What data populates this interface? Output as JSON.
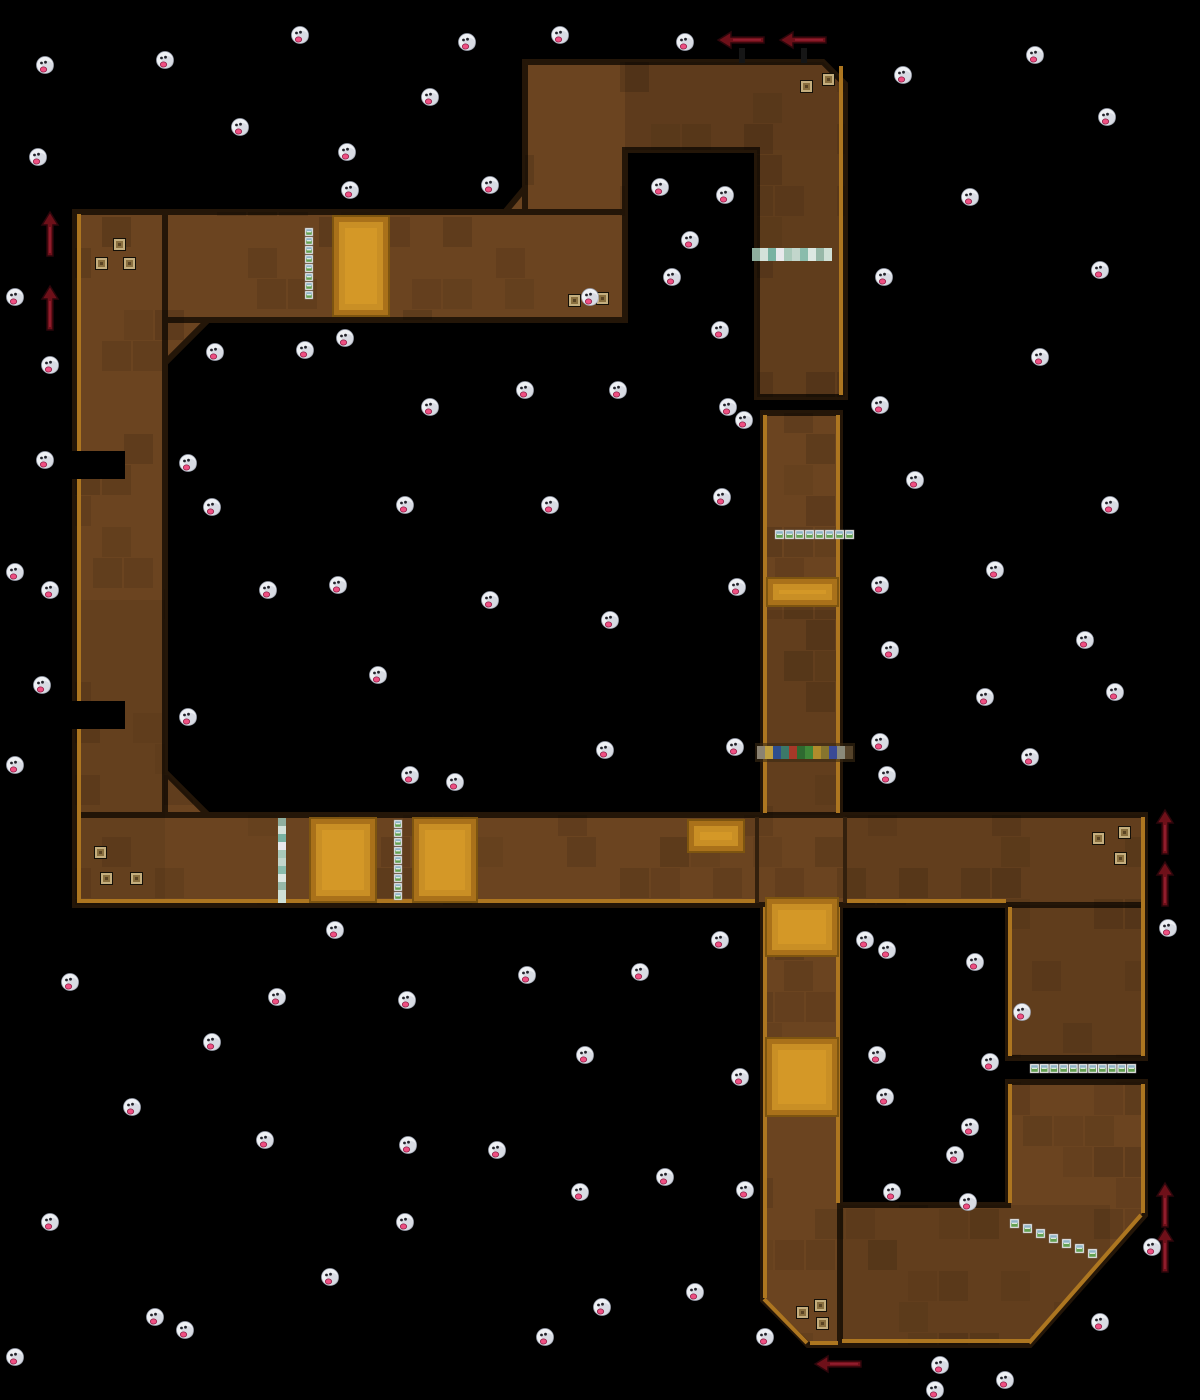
{
  "scene": {
    "width": 1200,
    "height": 1400,
    "background": "#000000"
  },
  "colors": {
    "track_fill": "#6b4420",
    "track_stroke": "#241608",
    "rim": "#ad7620",
    "seam": "#33200d",
    "pad_outer": "#a9711a",
    "pad_edge": "#7e5510",
    "pad_inner": "#c98f25",
    "pad_core": "#d69a28",
    "arrow_fill": "#6e1019",
    "arrow_edge": "#2c060b",
    "arrow_hl": "#a02438",
    "arrow_post": "#161616",
    "boo_body": "#eef0f4",
    "boo_shade": "#c6cad6",
    "boo_edge": "#9aa0ae",
    "boo_eye": "#23232b",
    "boo_tongue": "#ef4f82",
    "boo_tongue_edge": "#8e1f46",
    "box_border": "#f2f2f2",
    "box_top": "#8fb3c6",
    "box_bottom": "#63a052",
    "box_glint": "#ffffff",
    "block_outline": "#141008",
    "block_fill": "#c4ae7e",
    "block_mid": "#8a7040",
    "block_core": "#5a4424"
  },
  "track": {
    "pieces": [
      {
        "type": "poly",
        "name": "top-loop",
        "points": [
          [
            525,
            62
          ],
          [
            823,
            62
          ],
          [
            845,
            84
          ],
          [
            845,
            397
          ],
          [
            757,
            397
          ],
          [
            757,
            150
          ],
          [
            625,
            150
          ],
          [
            625,
            212
          ],
          [
            525,
            212
          ]
        ]
      },
      {
        "type": "rect",
        "name": "top-band",
        "x": 75,
        "y": 212,
        "w": 550,
        "h": 108
      },
      {
        "type": "rect",
        "name": "left-band",
        "x": 75,
        "y": 212,
        "w": 90,
        "h": 693
      },
      {
        "type": "rect",
        "name": "bottom-band",
        "x": 75,
        "y": 815,
        "w": 1070,
        "h": 90
      },
      {
        "type": "rect",
        "name": "mid-vertical",
        "x": 763,
        "y": 413,
        "w": 77,
        "h": 402
      },
      {
        "type": "poly",
        "name": "lower-vertical",
        "points": [
          [
            763,
            905
          ],
          [
            840,
            905
          ],
          [
            840,
            1345
          ],
          [
            808,
            1345
          ],
          [
            763,
            1300
          ]
        ]
      },
      {
        "type": "poly",
        "name": "loop-bottom",
        "points": [
          [
            1008,
            1082
          ],
          [
            1145,
            1082
          ],
          [
            1145,
            1215
          ],
          [
            1030,
            1345
          ],
          [
            840,
            1345
          ],
          [
            840,
            1205
          ],
          [
            1008,
            1205
          ]
        ]
      },
      {
        "type": "rect",
        "name": "loop-right-upper",
        "x": 1008,
        "y": 905,
        "w": 137,
        "h": 153
      },
      {
        "type": "poly",
        "name": "chamfer-a",
        "points": [
          [
            505,
            212
          ],
          [
            525,
            188
          ],
          [
            525,
            212
          ]
        ]
      },
      {
        "type": "poly",
        "name": "chamfer-b",
        "points": [
          [
            165,
            320
          ],
          [
            208,
            320
          ],
          [
            165,
            363
          ]
        ]
      },
      {
        "type": "poly",
        "name": "chamfer-c",
        "points": [
          [
            165,
            815
          ],
          [
            208,
            815
          ],
          [
            165,
            772
          ]
        ]
      }
    ],
    "notches": [
      [
        71,
        451,
        54,
        28
      ],
      [
        71,
        701,
        54,
        28
      ]
    ],
    "rims": [
      [
        79,
        214,
        79,
        903
      ],
      [
        841,
        66,
        841,
        395
      ],
      [
        1143,
        817,
        1143,
        1056
      ],
      [
        1143,
        1084,
        1143,
        1213
      ],
      [
        1141,
        1215,
        1029,
        1343
      ],
      [
        1031,
        1341,
        842,
        1341
      ],
      [
        838,
        1343,
        810,
        1343
      ],
      [
        807,
        1343,
        764,
        1299
      ],
      [
        77,
        901,
        755,
        901
      ],
      [
        847,
        901,
        1006,
        901
      ],
      [
        765,
        415,
        765,
        813
      ],
      [
        838,
        415,
        838,
        813
      ],
      [
        765,
        907,
        765,
        1298
      ],
      [
        838,
        907,
        838,
        1203
      ],
      [
        1010,
        907,
        1010,
        1056
      ],
      [
        1010,
        1084,
        1010,
        1203
      ]
    ],
    "seams": [
      [
        757,
        817,
        757,
        903
      ],
      [
        845,
        817,
        845,
        903
      ]
    ],
    "patches": [
      [
        625,
        62,
        218,
        88,
        0.12
      ],
      [
        757,
        150,
        86,
        247,
        0.1
      ],
      [
        845,
        815,
        298,
        88,
        0.08
      ],
      [
        763,
        610,
        77,
        205,
        0.08
      ],
      [
        75,
        600,
        90,
        300,
        0.06
      ],
      [
        840,
        1205,
        270,
        138,
        0.08
      ],
      [
        1008,
        905,
        137,
        151,
        0.1
      ]
    ]
  },
  "boost_pads": [
    [
      333,
      216,
      56,
      100
    ],
    [
      767,
      578,
      71,
      28
    ],
    [
      688,
      820,
      56,
      32
    ],
    [
      310,
      818,
      66,
      84
    ],
    [
      413,
      818,
      64,
      84
    ],
    [
      766,
      898,
      72,
      58
    ],
    [
      766,
      1038,
      72,
      78
    ]
  ],
  "item_box_groups": [
    {
      "x": 305,
      "y": 228,
      "count": 8,
      "dx": 0,
      "dy": 9,
      "size": 8
    },
    {
      "x": 775,
      "y": 530,
      "count": 8,
      "dx": 10,
      "dy": 0,
      "size": 9
    },
    {
      "x": 394,
      "y": 820,
      "count": 9,
      "dx": 0,
      "dy": 9,
      "size": 8
    },
    {
      "x": 1030,
      "y": 1064,
      "count": 11,
      "dx": 9.7,
      "dy": 0,
      "size": 9
    },
    {
      "x": 1010,
      "y": 1219,
      "count": 7,
      "dx": 13,
      "dy": 5,
      "size": 9
    }
  ],
  "pastel_strips": [
    {
      "x": 752,
      "y": 248,
      "count": 10,
      "dx": 8,
      "dy": 0,
      "size": 8
    },
    {
      "x": 278,
      "y": 818,
      "count": 10,
      "dx": 0,
      "dy": 8,
      "size": 8
    }
  ],
  "pastel_colors": [
    "#8fae9e",
    "#d4e2da",
    "#79b2a2",
    "#e9e9ec",
    "#a9c9ba",
    "#c2d6cc",
    "#8abcac",
    "#dde8e2",
    "#97b8a8",
    "#cfe0d6"
  ],
  "start_grid": {
    "x": 757,
    "y": 746,
    "size": 8,
    "height": 13,
    "colors": [
      "#8a8272",
      "#c0a040",
      "#2e4e8e",
      "#3c7868",
      "#a63828",
      "#2e6a30",
      "#3f8838",
      "#b08c2c",
      "#86742e",
      "#3a4a96",
      "#8a8a7a",
      "#55432a"
    ]
  },
  "blocks": [
    [
      800,
      80
    ],
    [
      822,
      73
    ],
    [
      113,
      238
    ],
    [
      95,
      257
    ],
    [
      123,
      257
    ],
    [
      568,
      294
    ],
    [
      596,
      292
    ],
    [
      94,
      846
    ],
    [
      100,
      872
    ],
    [
      130,
      872
    ],
    [
      1092,
      832
    ],
    [
      1118,
      826
    ],
    [
      1114,
      852
    ],
    [
      796,
      1306
    ],
    [
      814,
      1299
    ],
    [
      816,
      1317
    ]
  ],
  "arrows": [
    {
      "x": 718,
      "y": 32,
      "dir": "left",
      "post": true
    },
    {
      "x": 780,
      "y": 32,
      "dir": "left",
      "post": true
    },
    {
      "x": 42,
      "y": 212,
      "dir": "up",
      "post": false
    },
    {
      "x": 42,
      "y": 286,
      "dir": "up",
      "post": false
    },
    {
      "x": 1157,
      "y": 810,
      "dir": "up",
      "post": false
    },
    {
      "x": 1157,
      "y": 862,
      "dir": "up",
      "post": false
    },
    {
      "x": 1157,
      "y": 1183,
      "dir": "up",
      "post": false
    },
    {
      "x": 1157,
      "y": 1228,
      "dir": "up",
      "post": false
    },
    {
      "x": 815,
      "y": 1356,
      "dir": "left",
      "post": false
    }
  ],
  "boos": [
    [
      300,
      35
    ],
    [
      467,
      42
    ],
    [
      560,
      35
    ],
    [
      685,
      42
    ],
    [
      45,
      65
    ],
    [
      165,
      60
    ],
    [
      903,
      75
    ],
    [
      1035,
      55
    ],
    [
      430,
      97
    ],
    [
      240,
      127
    ],
    [
      1107,
      117
    ],
    [
      38,
      157
    ],
    [
      347,
      152
    ],
    [
      350,
      190
    ],
    [
      490,
      185
    ],
    [
      660,
      187
    ],
    [
      725,
      195
    ],
    [
      970,
      197
    ],
    [
      690,
      240
    ],
    [
      672,
      277
    ],
    [
      884,
      277
    ],
    [
      15,
      297
    ],
    [
      590,
      297
    ],
    [
      1100,
      270
    ],
    [
      720,
      330
    ],
    [
      215,
      352
    ],
    [
      50,
      365
    ],
    [
      305,
      350
    ],
    [
      345,
      338
    ],
    [
      1040,
      357
    ],
    [
      525,
      390
    ],
    [
      430,
      407
    ],
    [
      618,
      390
    ],
    [
      728,
      407
    ],
    [
      880,
      405
    ],
    [
      744,
      420
    ],
    [
      45,
      460
    ],
    [
      188,
      463
    ],
    [
      915,
      480
    ],
    [
      1110,
      505
    ],
    [
      212,
      507
    ],
    [
      405,
      505
    ],
    [
      550,
      505
    ],
    [
      722,
      497
    ],
    [
      15,
      572
    ],
    [
      50,
      590
    ],
    [
      268,
      590
    ],
    [
      338,
      585
    ],
    [
      490,
      600
    ],
    [
      737,
      587
    ],
    [
      880,
      585
    ],
    [
      995,
      570
    ],
    [
      610,
      620
    ],
    [
      890,
      650
    ],
    [
      1085,
      640
    ],
    [
      42,
      685
    ],
    [
      378,
      675
    ],
    [
      1115,
      692
    ],
    [
      985,
      697
    ],
    [
      188,
      717
    ],
    [
      1030,
      757
    ],
    [
      15,
      765
    ],
    [
      605,
      750
    ],
    [
      735,
      747
    ],
    [
      880,
      742
    ],
    [
      887,
      775
    ],
    [
      410,
      775
    ],
    [
      455,
      782
    ],
    [
      70,
      982
    ],
    [
      335,
      930
    ],
    [
      720,
      940
    ],
    [
      865,
      940
    ],
    [
      887,
      950
    ],
    [
      975,
      962
    ],
    [
      527,
      975
    ],
    [
      640,
      972
    ],
    [
      277,
      997
    ],
    [
      1022,
      1012
    ],
    [
      407,
      1000
    ],
    [
      212,
      1042
    ],
    [
      585,
      1055
    ],
    [
      877,
      1055
    ],
    [
      990,
      1062
    ],
    [
      740,
      1077
    ],
    [
      132,
      1107
    ],
    [
      885,
      1097
    ],
    [
      970,
      1127
    ],
    [
      265,
      1140
    ],
    [
      408,
      1145
    ],
    [
      497,
      1150
    ],
    [
      955,
      1155
    ],
    [
      665,
      1177
    ],
    [
      580,
      1192
    ],
    [
      745,
      1190
    ],
    [
      892,
      1192
    ],
    [
      968,
      1202
    ],
    [
      50,
      1222
    ],
    [
      405,
      1222
    ],
    [
      1100,
      1322
    ],
    [
      1152,
      1247
    ],
    [
      1168,
      928
    ],
    [
      330,
      1277
    ],
    [
      695,
      1292
    ],
    [
      155,
      1317
    ],
    [
      602,
      1307
    ],
    [
      185,
      1330
    ],
    [
      545,
      1337
    ],
    [
      765,
      1337
    ],
    [
      940,
      1365
    ],
    [
      1005,
      1380
    ],
    [
      15,
      1357
    ],
    [
      935,
      1390
    ]
  ]
}
